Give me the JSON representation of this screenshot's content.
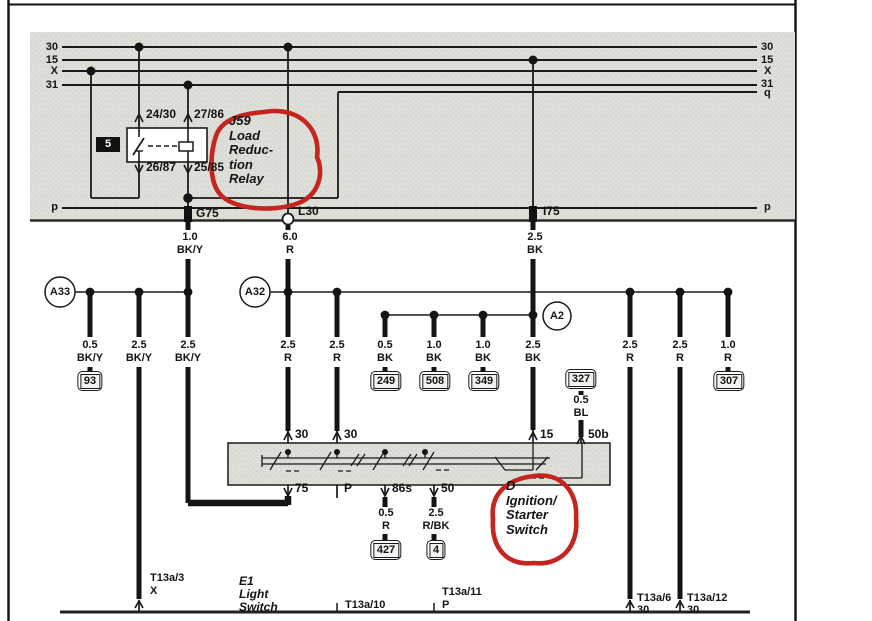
{
  "colors": {
    "annotation": "#c5251f",
    "line": "#161616",
    "shade": "#dedfd8"
  },
  "bus": {
    "left": {
      "b30": "30",
      "b15": "15",
      "bx": "X",
      "b31": "31",
      "bp": "p"
    },
    "right": {
      "b30": "30",
      "b15": "15",
      "bx": "X",
      "b31": "31",
      "bq": "q",
      "bp": "p"
    }
  },
  "relay": {
    "label_lines": [
      "J59",
      "Load",
      "Reduc-",
      "tion",
      "Relay"
    ],
    "slot": "5",
    "terminals": {
      "t1": "24/30",
      "t2": "27/86",
      "t3": "26/87",
      "t4": "25/85"
    }
  },
  "connectors": {
    "g75": "G75",
    "l30": "L30",
    "i75": "I75"
  },
  "feeds": {
    "g75_size": "1.0",
    "g75_color": "BK/Y",
    "l30_size": "6.0",
    "l30_color": "R",
    "i75_size": "2.5",
    "i75_color": "BK"
  },
  "nodes": {
    "a33": "A33",
    "a32": "A32",
    "a2": "A2"
  },
  "wires": [
    {
      "size": "0.5",
      "color": "BK/Y",
      "ground": "93"
    },
    {
      "size": "2.5",
      "color": "BK/Y"
    },
    {
      "size": "2.5",
      "color": "BK/Y"
    },
    {
      "size": "2.5",
      "color": "R"
    },
    {
      "size": "2.5",
      "color": "R"
    },
    {
      "size": "0.5",
      "color": "BK",
      "ground": "249"
    },
    {
      "size": "1.0",
      "color": "BK",
      "ground": "508"
    },
    {
      "size": "1.0",
      "color": "BK",
      "ground": "349"
    },
    {
      "size": "2.5",
      "color": "BK"
    },
    {
      "size": "2.5",
      "color": "R"
    },
    {
      "size": "2.5",
      "color": "R"
    },
    {
      "size": "1.0",
      "color": "R",
      "ground": "307"
    }
  ],
  "ignition_switch": {
    "label_lines": [
      "D",
      "Ignition/",
      "Starter",
      "Switch"
    ],
    "terminals_top": [
      "30",
      "30",
      "15",
      "50b"
    ],
    "terminals_bottom": [
      "75",
      "P",
      "86s",
      "50"
    ],
    "branch_50b": {
      "ground": "327",
      "size": "0.5",
      "color": "BL"
    },
    "outputs": [
      {
        "size": "0.5",
        "color": "R",
        "ground": "427"
      },
      {
        "size": "2.5",
        "color": "R/BK",
        "ground": "4"
      }
    ]
  },
  "light_switch": {
    "label_lines": [
      "E1",
      "Light",
      "Switch"
    ],
    "terminals": [
      {
        "pin": "T13a/3",
        "circuit": "X"
      },
      {
        "pin": "T13a/10",
        "circuit": ""
      },
      {
        "pin": "T13a/11",
        "circuit": "P"
      },
      {
        "pin": "T13a/6",
        "circuit": "30"
      },
      {
        "pin": "T13a/12",
        "circuit": "30"
      }
    ]
  }
}
